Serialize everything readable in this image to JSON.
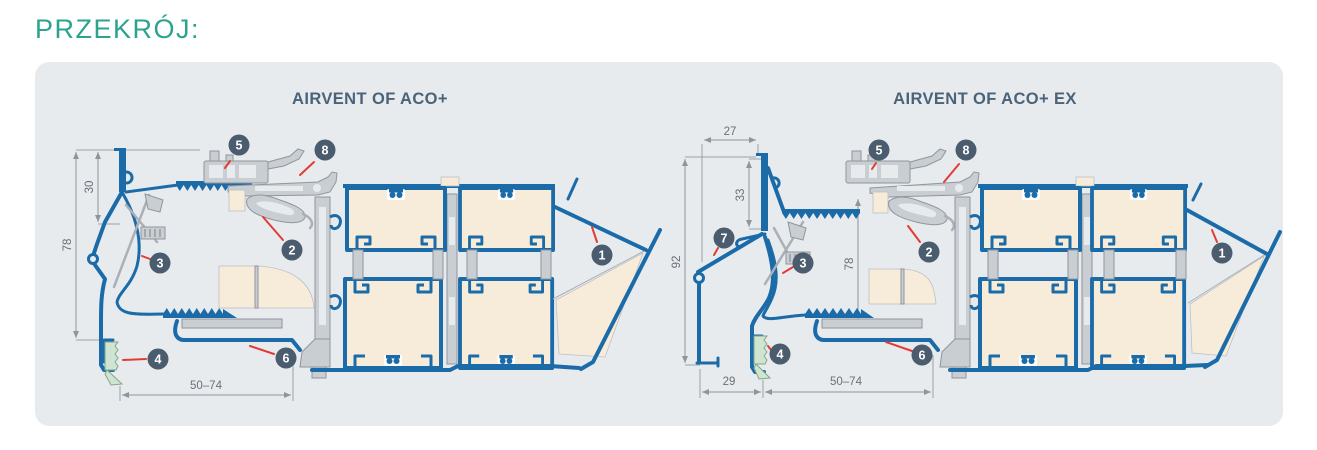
{
  "page": {
    "title": "PRZEKRÓJ:"
  },
  "colors": {
    "accent_teal": "#2BA38D",
    "heading_navy": "#4A6378",
    "profile_blue": "#1B6BA9",
    "aluminum_gray": "#C9CED3",
    "infill_cream": "#F6ECD9",
    "gasket_green": "#CFE5D2",
    "callout_navy": "#4A5C6E",
    "leader_red": "#E23C32",
    "panel_background": "#E8EBEE"
  },
  "figures": [
    {
      "title": "AIRVENT OF ACO+",
      "callouts": [
        "1",
        "2",
        "3",
        "4",
        "5",
        "6",
        "8"
      ],
      "dimensions": {
        "frame_height": "78",
        "top_inset": "30",
        "bottom_width": "50–74"
      }
    },
    {
      "title": "AIRVENT OF ACO+ EX",
      "callouts": [
        "1",
        "2",
        "3",
        "4",
        "5",
        "6",
        "7",
        "8"
      ],
      "dimensions": {
        "total_height": "92",
        "overhang": "27",
        "top_inset": "33",
        "frame_height": "78",
        "sill_width": "29",
        "bottom_width": "50–74"
      }
    }
  ]
}
